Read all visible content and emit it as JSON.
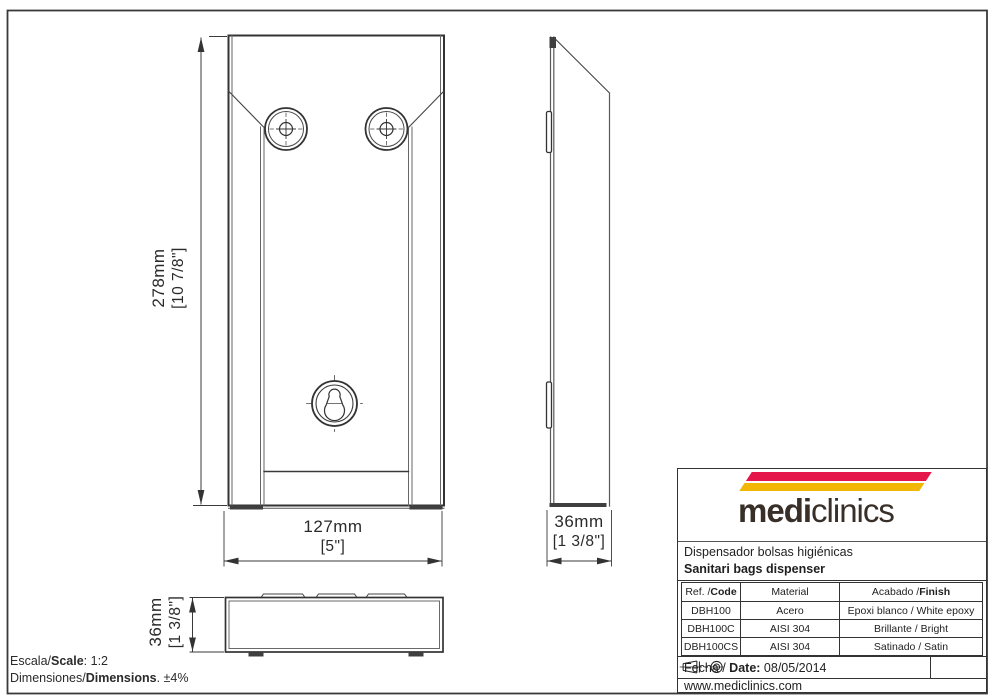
{
  "dimensions": {
    "height_mm": "278mm",
    "height_in": "[10 7/8\"]",
    "width_mm": "127mm",
    "width_in": "[5\"]",
    "depth_side_mm": "36mm",
    "depth_side_in": "[1 3/8\"]",
    "depth_bottom_mm": "36mm",
    "depth_bottom_in": "[1 3/8\"]"
  },
  "footer": {
    "scale_prefix": "Escala/",
    "scale_bold": "Scale",
    "scale_rest": ":  1:2",
    "dims_prefix": "Dimensiones/",
    "dims_bold": "Dimensions",
    "dims_rest": ". ±4%"
  },
  "title_block": {
    "logo": {
      "part_bold": "medi",
      "part_light": "clinics",
      "stripe_red": "#e5174a",
      "stripe_yellow": "#f2b705"
    },
    "product_es": "Dispensador bolsas higiénicas",
    "product_en": "Sanitari bags dispenser",
    "table": {
      "header_ref_regular": "Ref. / ",
      "header_ref_bold": "Code",
      "header_material": "Material",
      "header_finish_regular": "Acabado / ",
      "header_finish_bold": "Finish",
      "rows": [
        {
          "code": "DBH100",
          "material": "Acero",
          "finish": "Epoxi blanco / White epoxy"
        },
        {
          "code": "DBH100C",
          "material": "AISI 304",
          "finish": "Brillante / Bright"
        },
        {
          "code": "DBH100CS",
          "material": "AISI 304",
          "finish": "Satinado / Satin"
        }
      ]
    },
    "date_prefix": "Fecha / ",
    "date_bold": "Date:",
    "date_value": "08/05/2014",
    "website": "www.mediclinics.com"
  }
}
